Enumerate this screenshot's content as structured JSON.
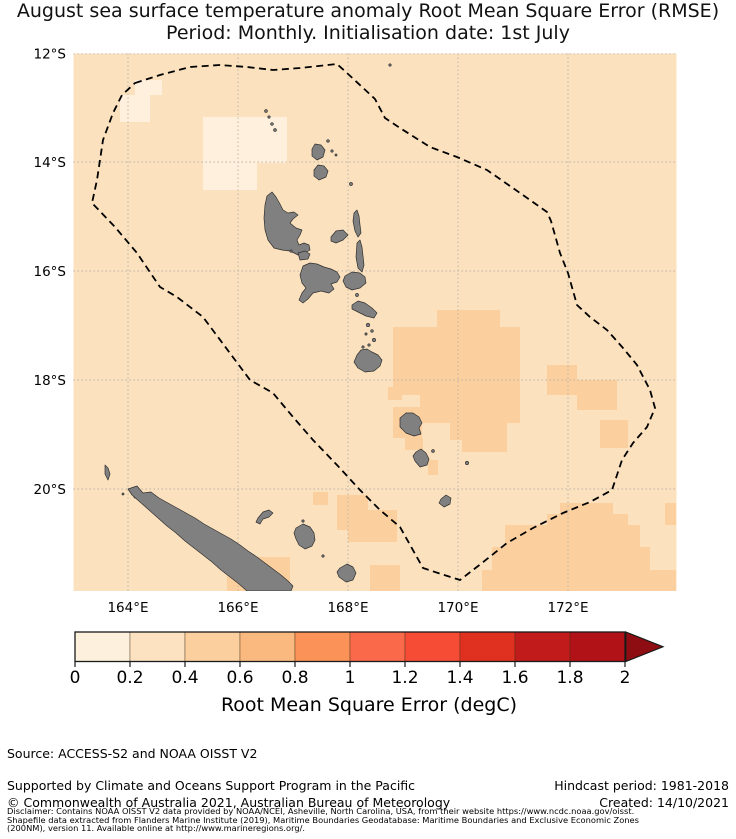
{
  "title": {
    "line1": "August sea surface temperature anomaly Root Mean Square Error (RMSE)",
    "line2": "Period: Monthly. Initialisation date: 1st July"
  },
  "map": {
    "lat_labels": [
      "12°S",
      "14°S",
      "16°S",
      "18°S",
      "20°S"
    ],
    "lon_labels": [
      "164°E",
      "166°E",
      "168°E",
      "170°E",
      "172°E"
    ],
    "region": "Vanuatu and New Caledonia",
    "boundary_style": "dashed EEZ outline"
  },
  "colors": {
    "map_bg": "#FBE1BE",
    "patch_low": "#FEF0DC",
    "patch_mid": "#FBCF9E",
    "island": "#808080",
    "island_edge": "#2F2F2F",
    "grid": "#B9B2A8",
    "eez": "#000000"
  },
  "colorbar": {
    "label": "Root Mean Square Error (degC)",
    "ticks": [
      "0",
      "0.2",
      "0.4",
      "0.6",
      "0.8",
      "1",
      "1.2",
      "1.4",
      "1.6",
      "1.8",
      "2"
    ],
    "colors": [
      "#FDF0DC",
      "#FCE2C0",
      "#FBCF9E",
      "#FAB97F",
      "#FB9257",
      "#F9694A",
      "#F64B34",
      "#E0301F",
      "#C11B1B",
      "#B01217"
    ],
    "arrow_color": "#8E0D12"
  },
  "footer": {
    "source": "Source: ACCESS-S2 and NOAA OISST V2",
    "supported": "Supported by Climate and Oceans Support Program in the Pacific",
    "copyright": "© Commonwealth of Australia 2021, Australian Bureau of Meteorology",
    "hindcast": "Hindcast period: 1981-2018",
    "created": "Created: 14/10/2021"
  },
  "disclaimer": {
    "line1": "Disclaimer: Contains NOAA OISST V2 data provided by NOAA/NCEI, Asheville, North Carolina, USA, from their website https://www.ncdc.noaa.gov/oisst.",
    "line2": "Shapefile data extracted from Flanders Marine Institute (2019), Maritime Boundaries Geodatabase: Maritime Boundaries and Exclusive Economic Zones",
    "line3": "(200NM), version 11. Available online at http://www.marineregions.org/."
  },
  "chart_data": {
    "type": "heatmap",
    "title": "August sea surface temperature anomaly Root Mean Square Error (RMSE)",
    "subtitle": "Period: Monthly. Initialisation date: 1st July",
    "colorbar_label": "Root Mean Square Error (degC)",
    "scale_ticks": [
      0,
      0.2,
      0.4,
      0.6,
      0.8,
      1,
      1.2,
      1.4,
      1.6,
      1.8,
      2
    ],
    "scale_step": 0.2,
    "lon_range_deg_east": [
      163,
      174
    ],
    "lat_range_deg_south": [
      12,
      21.8
    ],
    "dominant_value_band": "0.2-0.4 degC over most of the domain",
    "regions": [
      {
        "rmse_band": "0-0.2",
        "where": "north-west patches near 164-166E, 13-14.5S"
      },
      {
        "rmse_band": "0.4-0.6",
        "where": "central block 169-171.5E, 17-19S around Erromango"
      },
      {
        "rmse_band": "0.4-0.6",
        "where": "south-east corner 171-174E, 20-21.8S"
      },
      {
        "rmse_band": "0.4-0.6",
        "where": "around Loyalty Islands and south of New Caledonia 168-169.5E, 20-21.8S"
      }
    ],
    "land_features": [
      "Vanuatu archipelago (Santo, Malakula, Ambrym, Pentecost, Maewo, Ambae, Epi, Efate, Erromango, Tanna, Aneityum, Banks and Torres Islands)",
      "New Caledonia and Loyalty Islands"
    ],
    "overlay": "dashed Exclusive Economic Zone boundary polygon"
  }
}
